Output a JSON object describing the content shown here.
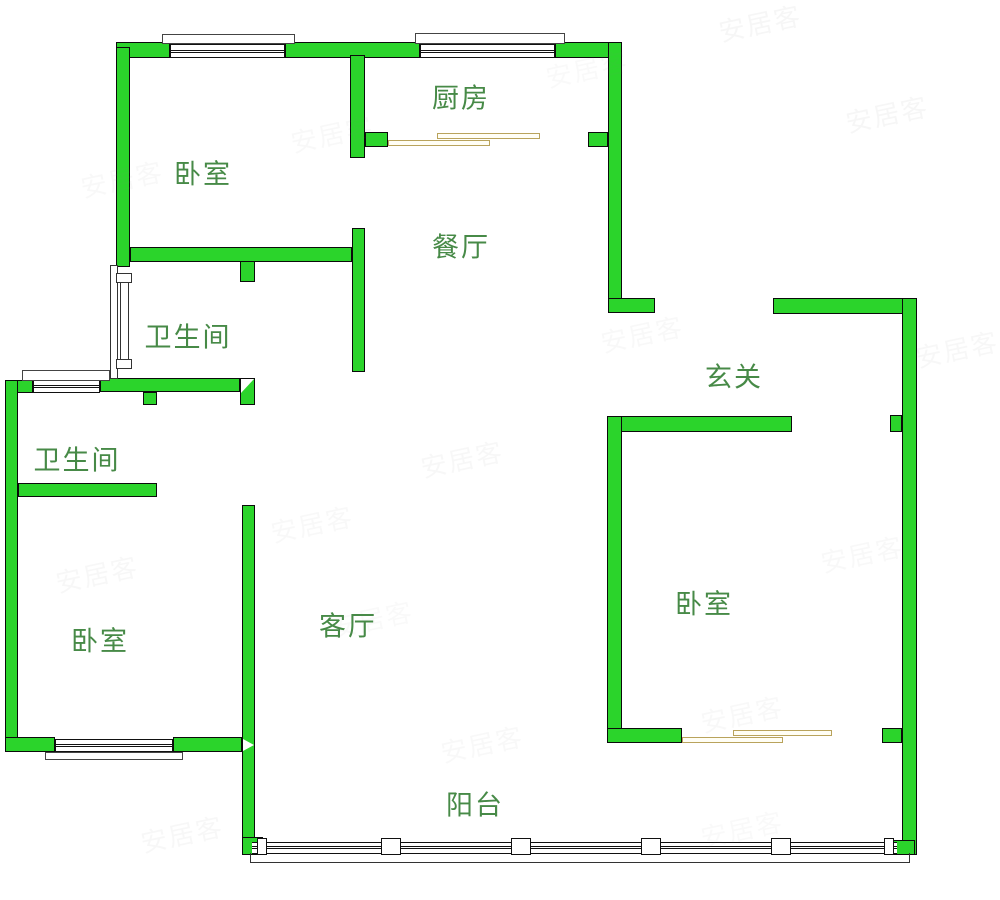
{
  "colors": {
    "wall_fill": "#2BD42B",
    "wall_border": "#0b0b0b",
    "label_text": "#478a47",
    "sliding_door": "#b9a35c",
    "watermark": "#8a8a8a"
  },
  "rooms": [
    {
      "id": "bedroom-top-left",
      "label": "卧室",
      "cx": 203,
      "cy": 175
    },
    {
      "id": "kitchen",
      "label": "厨房",
      "cx": 461,
      "cy": 99
    },
    {
      "id": "dining",
      "label": "餐厅",
      "cx": 461,
      "cy": 248
    },
    {
      "id": "bathroom-top",
      "label": "卫生间",
      "cx": 188,
      "cy": 338
    },
    {
      "id": "bathroom-lower",
      "label": "卫生间",
      "cx": 77,
      "cy": 461
    },
    {
      "id": "entry-hall",
      "label": "玄关",
      "cx": 734,
      "cy": 378
    },
    {
      "id": "bedroom-right",
      "label": "卧室",
      "cx": 704,
      "cy": 605
    },
    {
      "id": "bedroom-bottom-left",
      "label": "卧室",
      "cx": 100,
      "cy": 642
    },
    {
      "id": "living-room",
      "label": "客厅",
      "cx": 348,
      "cy": 627
    },
    {
      "id": "balcony",
      "label": "阳台",
      "cx": 475,
      "cy": 806
    }
  ],
  "watermark_text": "安居客",
  "watermarks": [
    {
      "x": 718,
      "y": 4,
      "o": 0.07
    },
    {
      "x": 845,
      "y": 95,
      "o": 0.07
    },
    {
      "x": 290,
      "y": 115,
      "o": 0.05
    },
    {
      "x": 80,
      "y": 160,
      "o": 0.05
    },
    {
      "x": 545,
      "y": 50,
      "o": 0.04
    },
    {
      "x": 600,
      "y": 315,
      "o": 0.05
    },
    {
      "x": 915,
      "y": 330,
      "o": 0.06
    },
    {
      "x": 420,
      "y": 440,
      "o": 0.06
    },
    {
      "x": 270,
      "y": 505,
      "o": 0.05
    },
    {
      "x": 55,
      "y": 555,
      "o": 0.06
    },
    {
      "x": 820,
      "y": 535,
      "o": 0.05
    },
    {
      "x": 330,
      "y": 600,
      "o": 0.04
    },
    {
      "x": 700,
      "y": 695,
      "o": 0.05
    },
    {
      "x": 440,
      "y": 725,
      "o": 0.05
    },
    {
      "x": 140,
      "y": 815,
      "o": 0.06
    },
    {
      "x": 700,
      "y": 810,
      "o": 0.04
    }
  ],
  "geometry": {
    "walls": [
      {
        "id": "top-wall-seg-a",
        "x": 116,
        "y": 42,
        "w": 54,
        "h": 16
      },
      {
        "id": "top-wall-seg-b",
        "x": 285,
        "y": 42,
        "w": 135,
        "h": 16
      },
      {
        "id": "top-wall-seg-c",
        "x": 555,
        "y": 42,
        "w": 67,
        "h": 16
      },
      {
        "id": "outer-left-upper",
        "x": 116,
        "y": 47,
        "w": 14,
        "h": 220
      },
      {
        "id": "kitchen-left-wall",
        "x": 350,
        "y": 55,
        "w": 15,
        "h": 103
      },
      {
        "id": "kitchen-door-jamb-left",
        "x": 365,
        "y": 132,
        "w": 23,
        "h": 15
      },
      {
        "id": "kitchen-door-jamb-right",
        "x": 588,
        "y": 132,
        "w": 20,
        "h": 15
      },
      {
        "id": "kitchen-right-wall",
        "x": 608,
        "y": 42,
        "w": 14,
        "h": 271
      },
      {
        "id": "bedroom1-bottom-wall",
        "x": 130,
        "y": 247,
        "w": 222,
        "h": 15
      },
      {
        "id": "bath1-door-jamb-top",
        "x": 240,
        "y": 261,
        "w": 15,
        "h": 21
      },
      {
        "id": "dining-left-wall",
        "x": 352,
        "y": 228,
        "w": 13,
        "h": 144
      },
      {
        "id": "entry-top-wall-left",
        "x": 608,
        "y": 298,
        "w": 47,
        "h": 15
      },
      {
        "id": "entry-top-wall-right",
        "x": 773,
        "y": 298,
        "w": 144,
        "h": 16
      },
      {
        "id": "outer-right-wall",
        "x": 902,
        "y": 298,
        "w": 15,
        "h": 557
      },
      {
        "id": "bedroom2-door-jamb",
        "x": 890,
        "y": 415,
        "w": 12,
        "h": 17
      },
      {
        "id": "bedroom2-top-wall",
        "x": 607,
        "y": 416,
        "w": 185,
        "h": 16
      },
      {
        "id": "bedroom2-left-wall",
        "x": 607,
        "y": 416,
        "w": 15,
        "h": 327
      },
      {
        "id": "bedroom2-bottom-wall",
        "x": 607,
        "y": 728,
        "w": 75,
        "h": 15
      },
      {
        "id": "bedroom2-bottom-stub",
        "x": 882,
        "y": 728,
        "w": 20,
        "h": 15
      },
      {
        "id": "bath2-top-wall-left",
        "x": 5,
        "y": 380,
        "w": 28,
        "h": 13
      },
      {
        "id": "bath-middle-wall",
        "x": 100,
        "y": 378,
        "w": 140,
        "h": 14
      },
      {
        "id": "outer-left-lower",
        "x": 5,
        "y": 380,
        "w": 13,
        "h": 372
      },
      {
        "id": "bath-middle-stub",
        "x": 143,
        "y": 392,
        "w": 14,
        "h": 13
      },
      {
        "id": "bath2-bottom-wall",
        "x": 18,
        "y": 483,
        "w": 139,
        "h": 14
      },
      {
        "id": "bedroom3-bottom-seg-left",
        "x": 5,
        "y": 737,
        "w": 50,
        "h": 15
      },
      {
        "id": "bedroom3-bottom-seg-right",
        "x": 173,
        "y": 737,
        "w": 69,
        "h": 15
      },
      {
        "id": "living-west-wall",
        "x": 242,
        "y": 505,
        "w": 13,
        "h": 350
      },
      {
        "id": "balcony-left-corner",
        "x": 242,
        "y": 837,
        "w": 21,
        "h": 18
      },
      {
        "id": "balcony-right-corner",
        "x": 893,
        "y": 840,
        "w": 22,
        "h": 15
      },
      {
        "id": "bath-door-end-block",
        "x": 240,
        "y": 378,
        "w": 15,
        "h": 27
      }
    ],
    "windows": [
      {
        "id": "window-bedroom1",
        "x": 170,
        "y": 44,
        "w": 115,
        "h": 14
      },
      {
        "id": "window-kitchen",
        "x": 420,
        "y": 44,
        "w": 135,
        "h": 14
      },
      {
        "id": "window-bath2",
        "x": 33,
        "y": 380,
        "w": 67,
        "h": 13
      },
      {
        "id": "window-bedroom3",
        "x": 55,
        "y": 739,
        "w": 118,
        "h": 13
      }
    ],
    "sills": [
      {
        "id": "sill-bedroom1",
        "x": 162,
        "y": 34,
        "w": 133,
        "h": 10
      },
      {
        "id": "sill-kitchen",
        "x": 415,
        "y": 33,
        "w": 150,
        "h": 11
      },
      {
        "id": "sill-bath2",
        "x": 22,
        "y": 370,
        "w": 88,
        "h": 11
      },
      {
        "id": "sill-bedroom3",
        "x": 45,
        "y": 752,
        "w": 138,
        "h": 8
      }
    ],
    "sliding_doors": [
      {
        "id": "kitchen-door-panel-a",
        "x": 388,
        "y": 140,
        "w": 102,
        "h": 6
      },
      {
        "id": "kitchen-door-panel-b",
        "x": 437,
        "y": 133,
        "w": 103,
        "h": 6
      },
      {
        "id": "bedroom2-door-panel-a",
        "x": 682,
        "y": 737,
        "w": 101,
        "h": 6
      },
      {
        "id": "bedroom2-door-panel-b",
        "x": 733,
        "y": 730,
        "w": 99,
        "h": 6
      }
    ],
    "door_frame": {
      "frame": {
        "x": 110,
        "y": 265,
        "w": 8,
        "h": 114
      },
      "block_top": {
        "x": 116,
        "y": 273,
        "w": 16,
        "h": 10
      },
      "block_bottom": {
        "x": 116,
        "y": 359,
        "w": 16,
        "h": 10
      },
      "leaf": {
        "x": 120,
        "y": 283,
        "w": 9,
        "h": 76
      }
    },
    "railing": {
      "band": {
        "x": 252,
        "y": 842,
        "w": 645,
        "h": 12
      },
      "mullions": [
        {
          "x": 257,
          "y": 838,
          "w": 10,
          "h": 17
        },
        {
          "x": 381,
          "y": 838,
          "w": 20,
          "h": 17
        },
        {
          "x": 511,
          "y": 838,
          "w": 20,
          "h": 17
        },
        {
          "x": 641,
          "y": 838,
          "w": 20,
          "h": 17
        },
        {
          "x": 771,
          "y": 838,
          "w": 20,
          "h": 17
        },
        {
          "x": 884,
          "y": 838,
          "w": 10,
          "h": 17
        }
      ]
    },
    "balcony_outline": {
      "x": 250,
      "y": 853,
      "w": 660,
      "h": 10
    },
    "triangles": [
      {
        "id": "bath-doorway-triangle",
        "x": 241,
        "y": 379,
        "w": 13,
        "h": 14,
        "dir": "tl"
      },
      {
        "id": "living-doorway-arrow",
        "x": 243,
        "y": 739,
        "w": 11,
        "h": 12,
        "dir": "right"
      }
    ]
  }
}
